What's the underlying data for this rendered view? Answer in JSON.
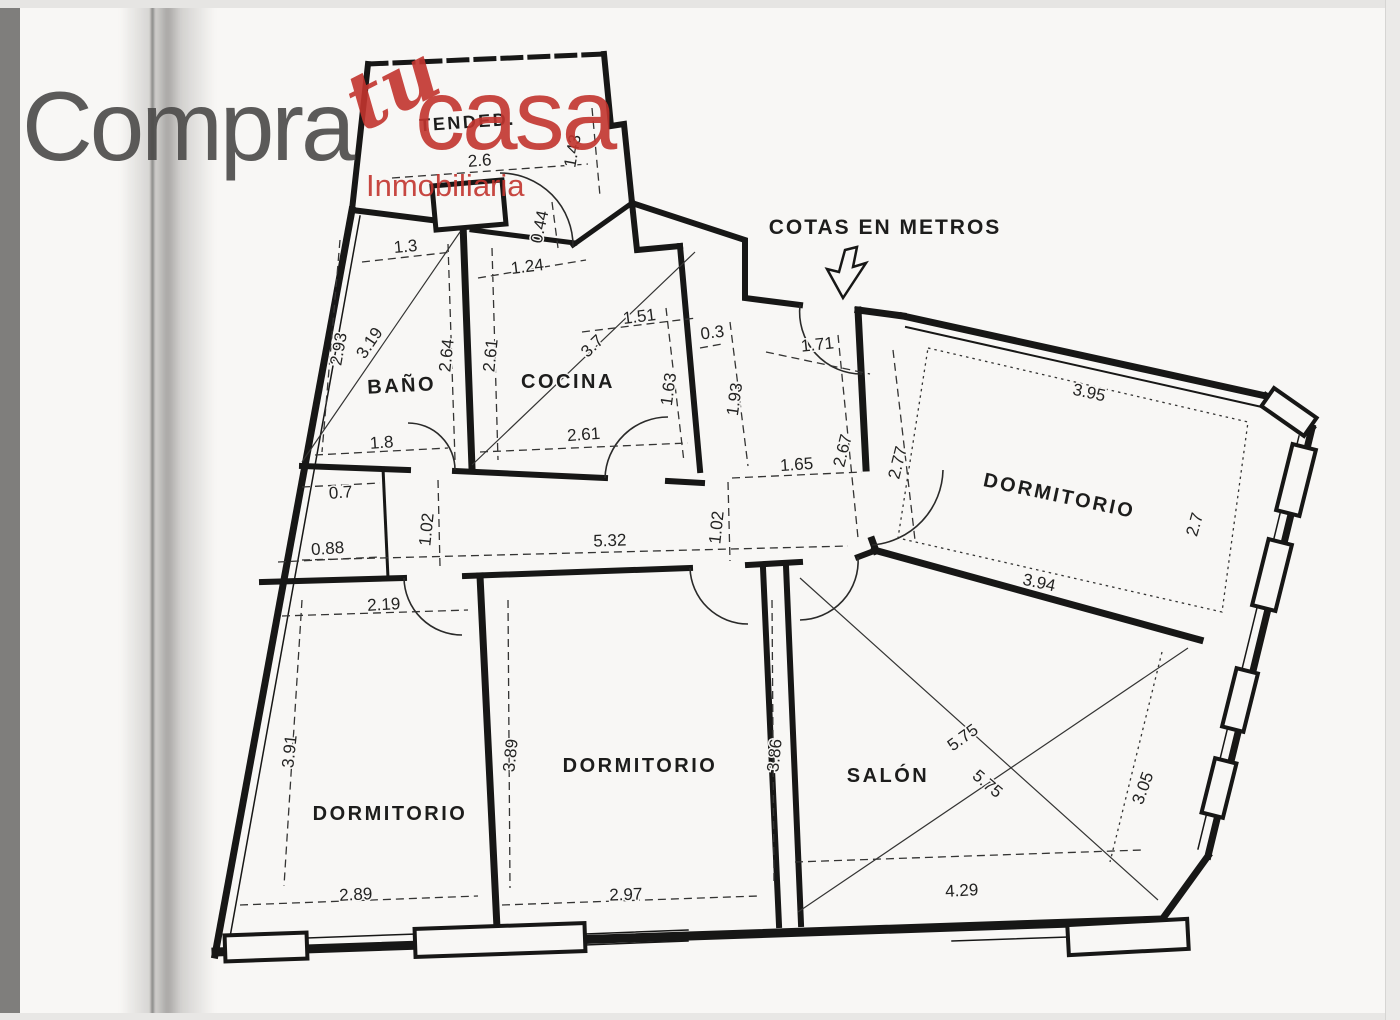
{
  "logo": {
    "word1": "Compra",
    "word2": "tu",
    "word3": "casa",
    "tagline": "Inmobiliaria",
    "color_dark": "#4b4a49",
    "color_red": "#c2342e"
  },
  "floorplan": {
    "annotation": "COTAS EN METROS",
    "rooms": [
      {
        "name": "TENDED."
      },
      {
        "name": "BAÑO"
      },
      {
        "name": "COCINA"
      },
      {
        "name": "DORMITORIO"
      },
      {
        "name": "DORMITORIO"
      },
      {
        "name": "DORMITORIO"
      },
      {
        "name": "SALÓN"
      }
    ],
    "dims": [
      "2.6",
      "1.43",
      "0.44",
      "1.3",
      "1.24",
      "2.93",
      "3.19",
      "2.64",
      "2.61",
      "3.7",
      "1.51",
      "0.3",
      "1.63",
      "1.93",
      "1.71",
      "2.67",
      "2.77",
      "1.8",
      "2.61",
      "1.65",
      "0.7",
      "0.88",
      "1.02",
      "5.32",
      "1.02",
      "3.95",
      "2.7",
      "3.94",
      "2.19",
      "3.91",
      "2.89",
      "3.89",
      "2.97",
      "3.86",
      "5.75",
      "5.75",
      "4.29",
      "3.05"
    ]
  }
}
